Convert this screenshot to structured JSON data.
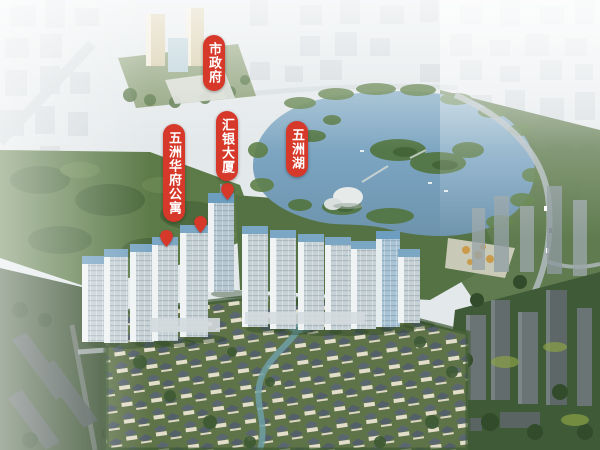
{
  "scene": {
    "description": "Aerial 3D rendering of Wuzhou Lake real-estate master plan with red annotation labels",
    "labels": {
      "city_hall": "市政府",
      "huiyin_tower": "汇银大厦",
      "wuzhou_lake": "五洲湖",
      "huafu_apartments": "五洲华府公寓"
    },
    "markers": [
      {
        "name": "huiyin-tower-pin"
      },
      {
        "name": "huafu-apartments-pin-left"
      },
      {
        "name": "huafu-apartments-pin-right"
      }
    ],
    "colors": {
      "label_red": "#d63829",
      "lake_blue": "#7aa3c0",
      "forest_green": "#547244",
      "haze_white": "#eef1f2",
      "villa_wall": "#eae4d1",
      "villa_roof": "#5a6673"
    }
  }
}
